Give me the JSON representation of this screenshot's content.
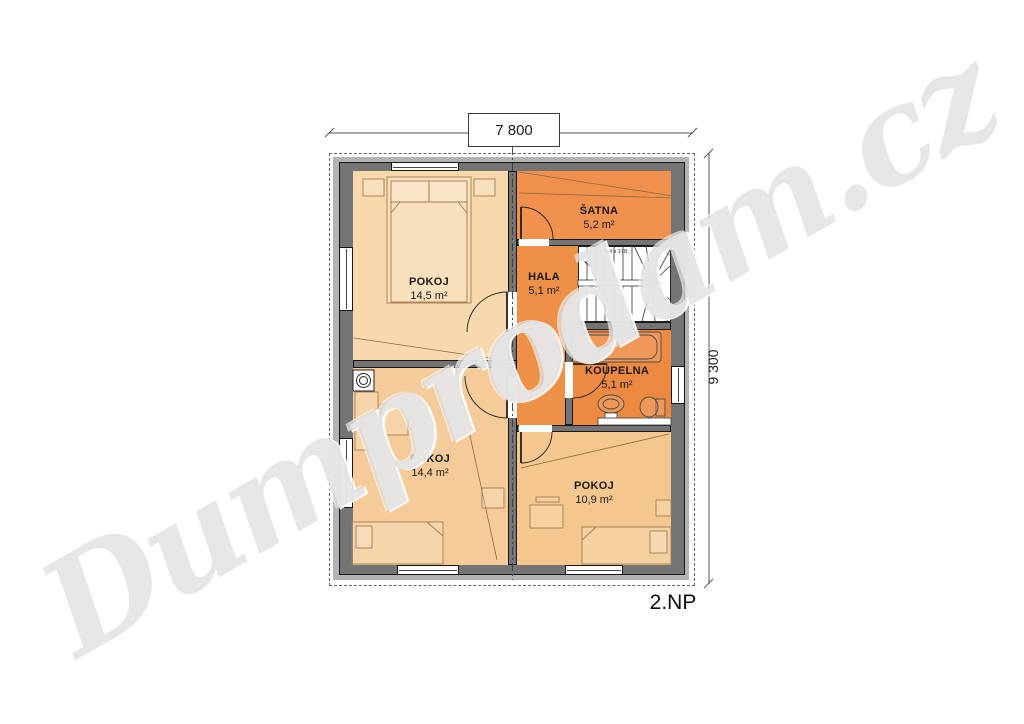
{
  "floor_label": "2.NP",
  "dimensions": {
    "width": "7 800",
    "height": "9 300"
  },
  "stairs_note": "17 x 264 x 178",
  "rooms": [
    {
      "name": "POKOJ",
      "area": "14,5 m²"
    },
    {
      "name": "ŠATNA",
      "area": "5,2 m²"
    },
    {
      "name": "HALA",
      "area": "5,1 m²"
    },
    {
      "name": "KOUPELNA",
      "area": "5,1 m²"
    },
    {
      "name": "POKOJ",
      "area": "14,4 m²"
    },
    {
      "name": "POKOJ",
      "area": "10,9 m²"
    }
  ],
  "watermark": {
    "text": "Dumprodam.cz"
  },
  "colors": {
    "room_pokoj_tl": "#F8D9AE",
    "room_pokoj_bl": "#F5CC99",
    "room_pokoj_br": "#F3C78E",
    "room_satna": "#F0914E",
    "room_hala": "#ED9149",
    "room_koupelna": "#ED8A42",
    "wall": "#747474",
    "wall_ring": "#B3B3B3",
    "stairs": "#FFFFFF"
  }
}
